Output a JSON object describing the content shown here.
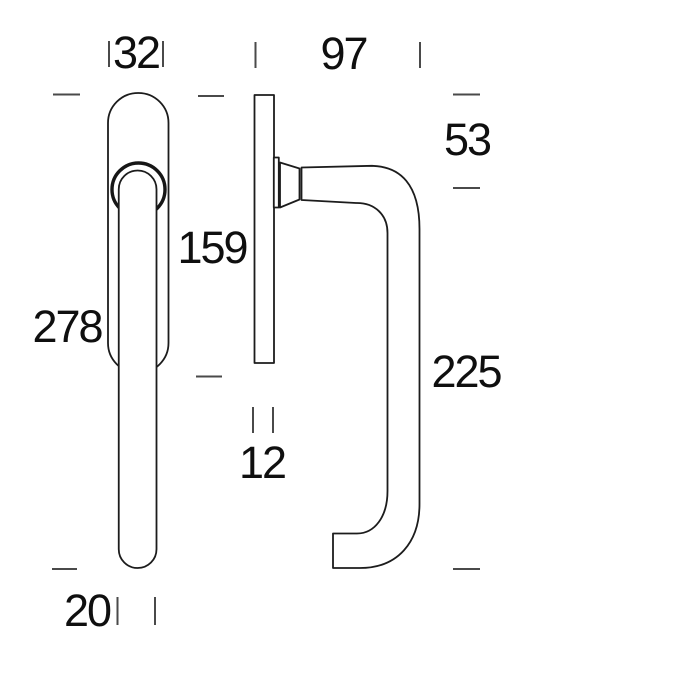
{
  "drawing": {
    "background_color": "#ffffff",
    "line_color": "#1c1c1c",
    "dimension_mark_color": "#4a4a4a",
    "text_color": "#0f0f0f",
    "dimensions": {
      "handle_width": "32",
      "projection_depth": "97",
      "neck_offset": "53",
      "upper_length": "159",
      "total_height": "278",
      "grip_length": "225",
      "plate_thickness": "12",
      "grip_width": "20"
    }
  }
}
